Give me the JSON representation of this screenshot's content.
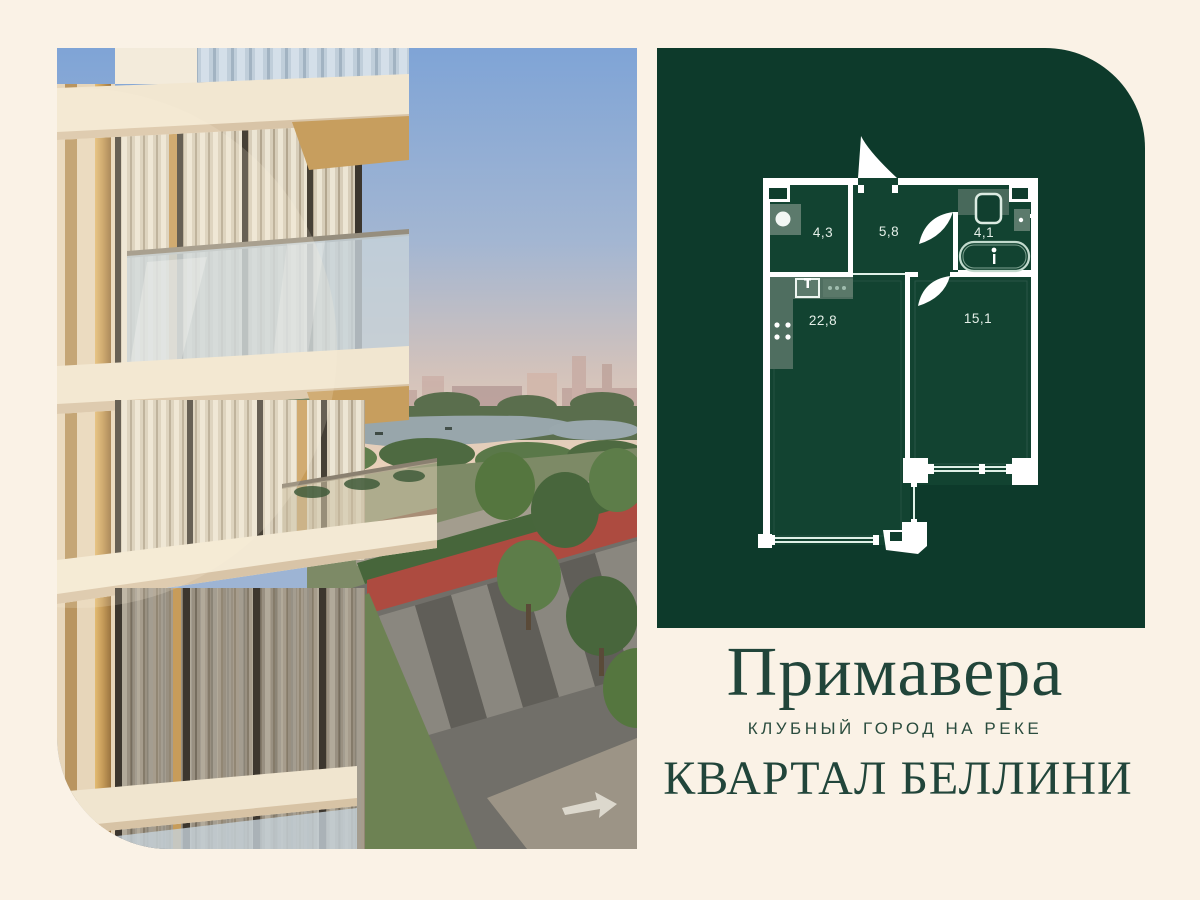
{
  "page": {
    "background_color": "#faf2e6"
  },
  "panel": {
    "background_color": "#0d3a2b"
  },
  "brand": {
    "title": "Примавера",
    "subtitle": "КЛУБНЫЙ ГОРОД НА РЕКЕ",
    "quarter": "КВАРТАЛ БЕЛЛИНИ",
    "text_color": "#21453a"
  },
  "floor_plan": {
    "wall_color": "#ffffff",
    "label_color": "#e4efe8",
    "rooms": [
      {
        "name": "hallway",
        "area": "4,3"
      },
      {
        "name": "entry-hall",
        "area": "5,8"
      },
      {
        "name": "bathroom",
        "area": "4,1"
      },
      {
        "name": "kitchen-living",
        "area": "22,8"
      },
      {
        "name": "bedroom",
        "area": "15,1"
      }
    ]
  }
}
